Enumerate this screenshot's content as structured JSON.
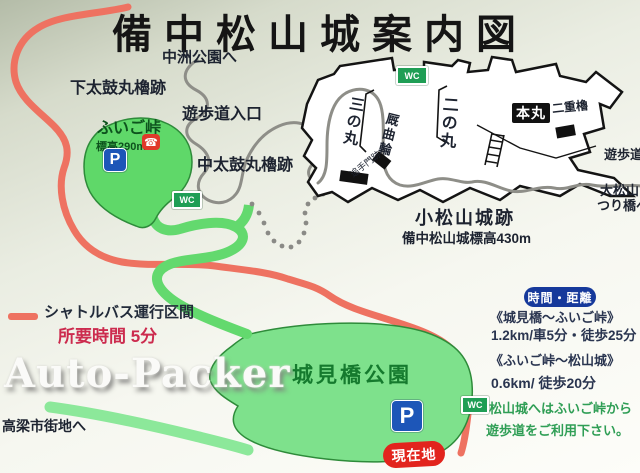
{
  "title": "備中松山城案内図",
  "labels": {
    "nakasu_park": "中洲公園へ",
    "shimo_taiko": "下太鼓丸櫓跡",
    "promenade_entrance": "遊歩道入口",
    "naka_taiko": "中太鼓丸櫓跡",
    "otemon": "追手門跡",
    "sannomaru": "三の丸",
    "umaya_kuruwa": "厩曲輪",
    "ninomaru": "二の丸",
    "honmaru": "本丸",
    "nijuyagura": "二重櫓",
    "komatsuyama": "小松山城跡",
    "komatsuyama_elev": "備中松山城標高430m",
    "promenade_right": "遊歩道",
    "omatsuyama": "大松山",
    "tsuribashi": "つり橋へ",
    "shiromibashi_park": "城見橋公園",
    "takahashi": "高梁市街地へ",
    "genzaichi": "現在地"
  },
  "fuigo": {
    "name": "ふいご峠",
    "elevation": "標高290m"
  },
  "icons": {
    "parking": "P",
    "toilet": "WC",
    "phone": "☎"
  },
  "legend": {
    "shuttle": "シャトルバス運行区間",
    "time": "所要時間 5分"
  },
  "infobox": {
    "badge": "時間・距離",
    "row1_title": "《城見橋～ふいご峠》",
    "row1_value": "1.2km/車5分・徒歩25分",
    "row2_title": "《ふいご峠～松山城》",
    "row2_value": "0.6km/ 徒歩20分",
    "note1": "松山城へはふいご峠から",
    "note2": "遊歩道をご利用下さい。"
  },
  "watermark": "Auto-Packer",
  "colors": {
    "shuttle_red": "#ee7261",
    "road_green": "#63d96e",
    "area_green": "#6ee07c",
    "parking_blue": "#1d56b8",
    "toilet_green": "#1f9e55",
    "info_navy": "#16399b",
    "note_green": "#2f9e55",
    "current_red": "#e2241d",
    "time_red": "#cc2b4e"
  }
}
